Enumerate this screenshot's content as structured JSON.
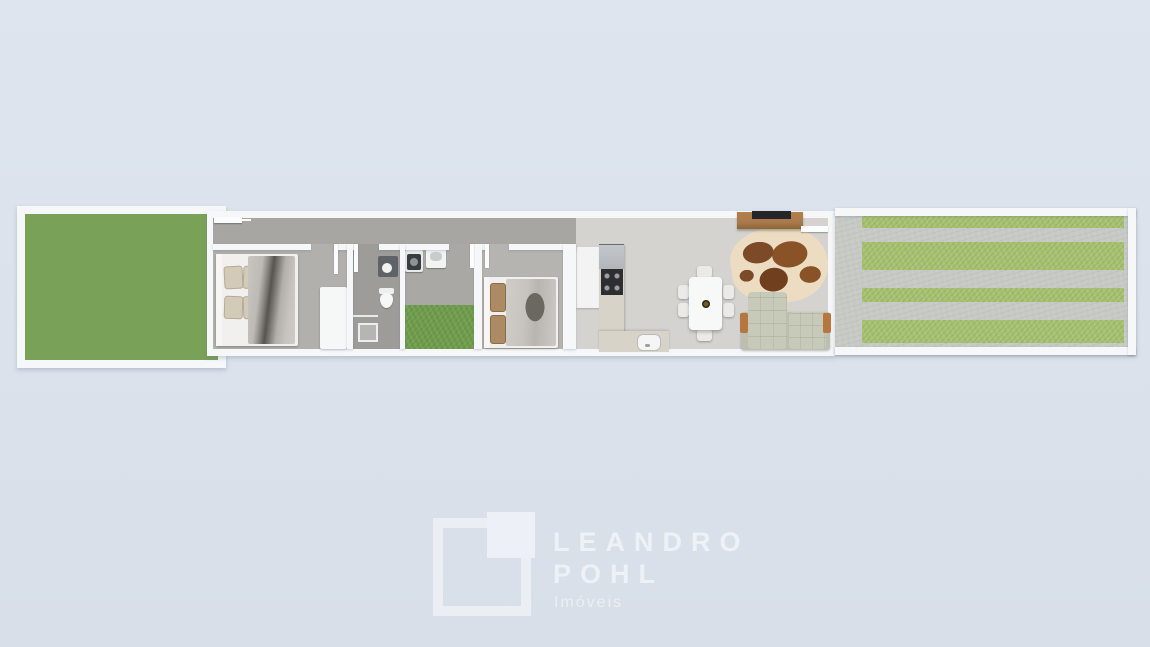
{
  "type": "floor-plan-3d-render",
  "watermark": {
    "brand_line1": "LEANDRO",
    "brand_line2": "POHL",
    "tagline": "Imóveis"
  },
  "palette": {
    "background": "#dee5ef",
    "background2": "#d8dfe9",
    "wall": "#f5f7f9",
    "yard_grass": "#7aa158",
    "patch_grass": "#6f9c4b",
    "stripe_grass": "#a5c170",
    "concrete": "#c6c9c4",
    "corridor_floor": "#a8a6a3",
    "bedroom1_floor": "#b2b0ad",
    "bathroom_floor": "#9d9c99",
    "laundry_floor": "#aaa8a5",
    "bedroom2_floor": "#b6b4b1",
    "living_floor": "#d4d3d0",
    "counter": "#d8d3c8",
    "steel": "#b2b6ba",
    "stove": "#2e2e30",
    "wood": "#a97a4c",
    "tv": "#26262a",
    "sofa": "#c7cab8",
    "sofa_seat": "#bcbfad",
    "cowhide_base": "#ecdcc2",
    "cowhide_brown": "#7c4a26",
    "duvet_gray": "#c6c3be",
    "duvet_dark": "#57544f",
    "pillow_tan": "#d3cab8",
    "pillow_brown": "#ab8a64"
  },
  "floorplan": {
    "rooms": [
      "front yard",
      "hallway",
      "bedroom 1",
      "bathroom",
      "laundry patio",
      "bedroom 2",
      "kitchen",
      "dining area",
      "living room",
      "striped driveway"
    ],
    "furniture": [
      "double bed",
      "wardrobe",
      "vanity sink",
      "toilet",
      "shower",
      "washing machine",
      "laundry tank",
      "double bed",
      "fridge",
      "L-shaped counter",
      "cooktop",
      "kitchen sink",
      "dining table",
      "6 chairs",
      "tv stand",
      "tv",
      "cowhide rug",
      "sofa"
    ]
  }
}
